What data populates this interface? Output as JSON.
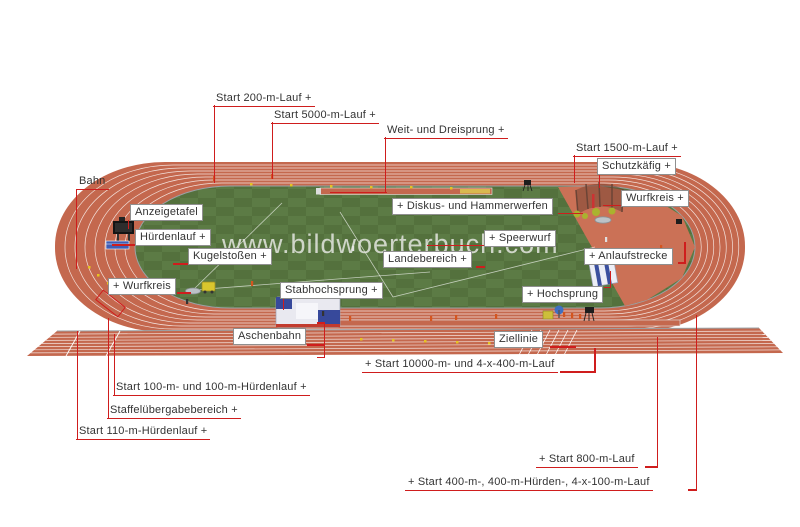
{
  "watermark": "www.bildwoerterbuch.com",
  "colors": {
    "leader": "#cf1d1d",
    "track": "#c4684e",
    "apron": "#cb7156",
    "grass_dark": "#54713d",
    "grass_light": "#5c7b45",
    "sand": "#d9b84f",
    "label_text": "#333333",
    "box_border": "#8f8f8f"
  },
  "labels": [
    {
      "id": "start-200m",
      "text": "Start 200-m-Lauf +",
      "x": 213,
      "y": 92,
      "boxed": false
    },
    {
      "id": "start-5000m",
      "text": "Start 5000-m-Lauf +",
      "x": 271,
      "y": 109,
      "boxed": false
    },
    {
      "id": "weit-dreisprung",
      "text": "Weit- und Dreisprung +",
      "x": 384,
      "y": 124,
      "boxed": false
    },
    {
      "id": "start-1500m",
      "text": "Start 1500-m-Lauf +",
      "x": 573,
      "y": 142,
      "boxed": false
    },
    {
      "id": "bahn",
      "text": "Bahn",
      "x": 76,
      "y": 175,
      "boxed": false
    },
    {
      "id": "schutzkaefig",
      "text": "Schutzkäfig +",
      "x": 597,
      "y": 158,
      "boxed": true
    },
    {
      "id": "wurfkreis-right",
      "text": "Wurfkreis +",
      "x": 621,
      "y": 190,
      "boxed": true
    },
    {
      "id": "anzeigetafel",
      "text": "Anzeigetafel",
      "x": 130,
      "y": 204,
      "boxed": true
    },
    {
      "id": "diskus-hammerwerfen",
      "text": "+ Diskus- und Hammerwerfen",
      "x": 392,
      "y": 198,
      "boxed": true
    },
    {
      "id": "huerdenlauf",
      "text": "Hürdenlauf +",
      "x": 135,
      "y": 229,
      "boxed": true
    },
    {
      "id": "speerwurf",
      "text": "+ Speerwurf",
      "x": 484,
      "y": 230,
      "boxed": true
    },
    {
      "id": "kugelstossen",
      "text": "Kugelstoßen +",
      "x": 188,
      "y": 248,
      "boxed": true
    },
    {
      "id": "landebereich",
      "text": "Landebereich +",
      "x": 383,
      "y": 251,
      "boxed": true
    },
    {
      "id": "anlaufstrecke",
      "text": "+ Anlaufstrecke",
      "x": 584,
      "y": 248,
      "boxed": true
    },
    {
      "id": "wurfkreis-left",
      "text": "+ Wurfkreis",
      "x": 108,
      "y": 278,
      "boxed": true
    },
    {
      "id": "stabhochsprung",
      "text": "Stabhochsprung +",
      "x": 280,
      "y": 282,
      "boxed": true
    },
    {
      "id": "hochsprung",
      "text": "+ Hochsprung",
      "x": 522,
      "y": 286,
      "boxed": true
    },
    {
      "id": "aschenbahn",
      "text": "Aschenbahn",
      "x": 233,
      "y": 328,
      "boxed": true
    },
    {
      "id": "ziellinie",
      "text": "Ziellinie",
      "x": 494,
      "y": 331,
      "boxed": true
    },
    {
      "id": "start-10000m-4x400m",
      "text": "+ Start 10000-m- und 4-x-400-m-Lauf",
      "x": 362,
      "y": 358,
      "boxed": false
    },
    {
      "id": "start-100m",
      "text": "Start 100-m- und 100-m-Hürdenlauf +",
      "x": 113,
      "y": 381,
      "boxed": false
    },
    {
      "id": "staffeluebergabebereich",
      "text": "Staffelübergabebereich +",
      "x": 107,
      "y": 404,
      "boxed": false
    },
    {
      "id": "start-110m-huerden",
      "text": "Start 110-m-Hürdenlauf +",
      "x": 76,
      "y": 425,
      "boxed": false
    },
    {
      "id": "start-800m",
      "text": "+ Start 800-m-Lauf",
      "x": 536,
      "y": 453,
      "boxed": false
    },
    {
      "id": "start-400m",
      "text": "+ Start 400-m-, 400-m-Hürden-, 4-x-100-m-Lauf",
      "x": 405,
      "y": 476,
      "boxed": false
    }
  ],
  "leader_segments": [
    [
      213.5,
      105,
      1.5,
      78
    ],
    [
      271.5,
      122,
      1.5,
      57
    ],
    [
      384.5,
      137,
      1.5,
      56
    ],
    [
      330,
      191.5,
      57,
      1.5
    ],
    [
      573.5,
      155,
      1.5,
      28
    ],
    [
      75.5,
      189,
      1.5,
      80
    ],
    [
      560,
      371,
      36,
      1.5
    ],
    [
      594,
      348,
      1.5,
      24.5
    ],
    [
      113.5,
      334,
      1.5,
      62
    ],
    [
      107.5,
      318,
      1.5,
      101
    ],
    [
      76.5,
      331,
      1.5,
      109
    ],
    [
      645,
      466,
      13,
      1.5
    ],
    [
      656.5,
      337,
      1.5,
      130.5
    ],
    [
      688,
      489,
      9,
      1.5
    ],
    [
      695.5,
      315,
      1.5,
      175.5
    ],
    [
      127.5,
      220,
      1.5,
      9
    ],
    [
      112,
      244,
      24,
      1.5
    ],
    [
      173,
      263,
      16,
      1.5
    ],
    [
      177,
      292,
      14,
      1.5
    ],
    [
      282.5,
      298,
      1.5,
      12
    ],
    [
      476,
      266,
      9,
      1.5
    ],
    [
      558,
      212.5,
      25,
      1.5
    ],
    [
      427,
      244.5,
      58,
      1.5
    ],
    [
      678,
      262,
      8,
      1.5
    ],
    [
      684,
      242,
      1.5,
      21
    ],
    [
      604,
      286.5,
      7,
      1.5
    ],
    [
      609.5,
      271,
      1.5,
      16
    ],
    [
      598.5,
      174,
      1.5,
      14
    ],
    [
      603,
      204.5,
      19,
      1.5
    ],
    [
      307,
      344,
      18,
      1.5
    ],
    [
      323.5,
      322,
      1.5,
      36
    ],
    [
      317,
      322,
      8,
      1.5
    ],
    [
      317,
      356.5,
      8,
      1.5
    ],
    [
      550,
      346,
      26,
      1.5
    ]
  ],
  "marker_shapes": [
    {
      "id": "relay-exchange-zone-marker",
      "x": 96,
      "y": 297,
      "w": 27,
      "h": 11,
      "deg": 38
    }
  ]
}
